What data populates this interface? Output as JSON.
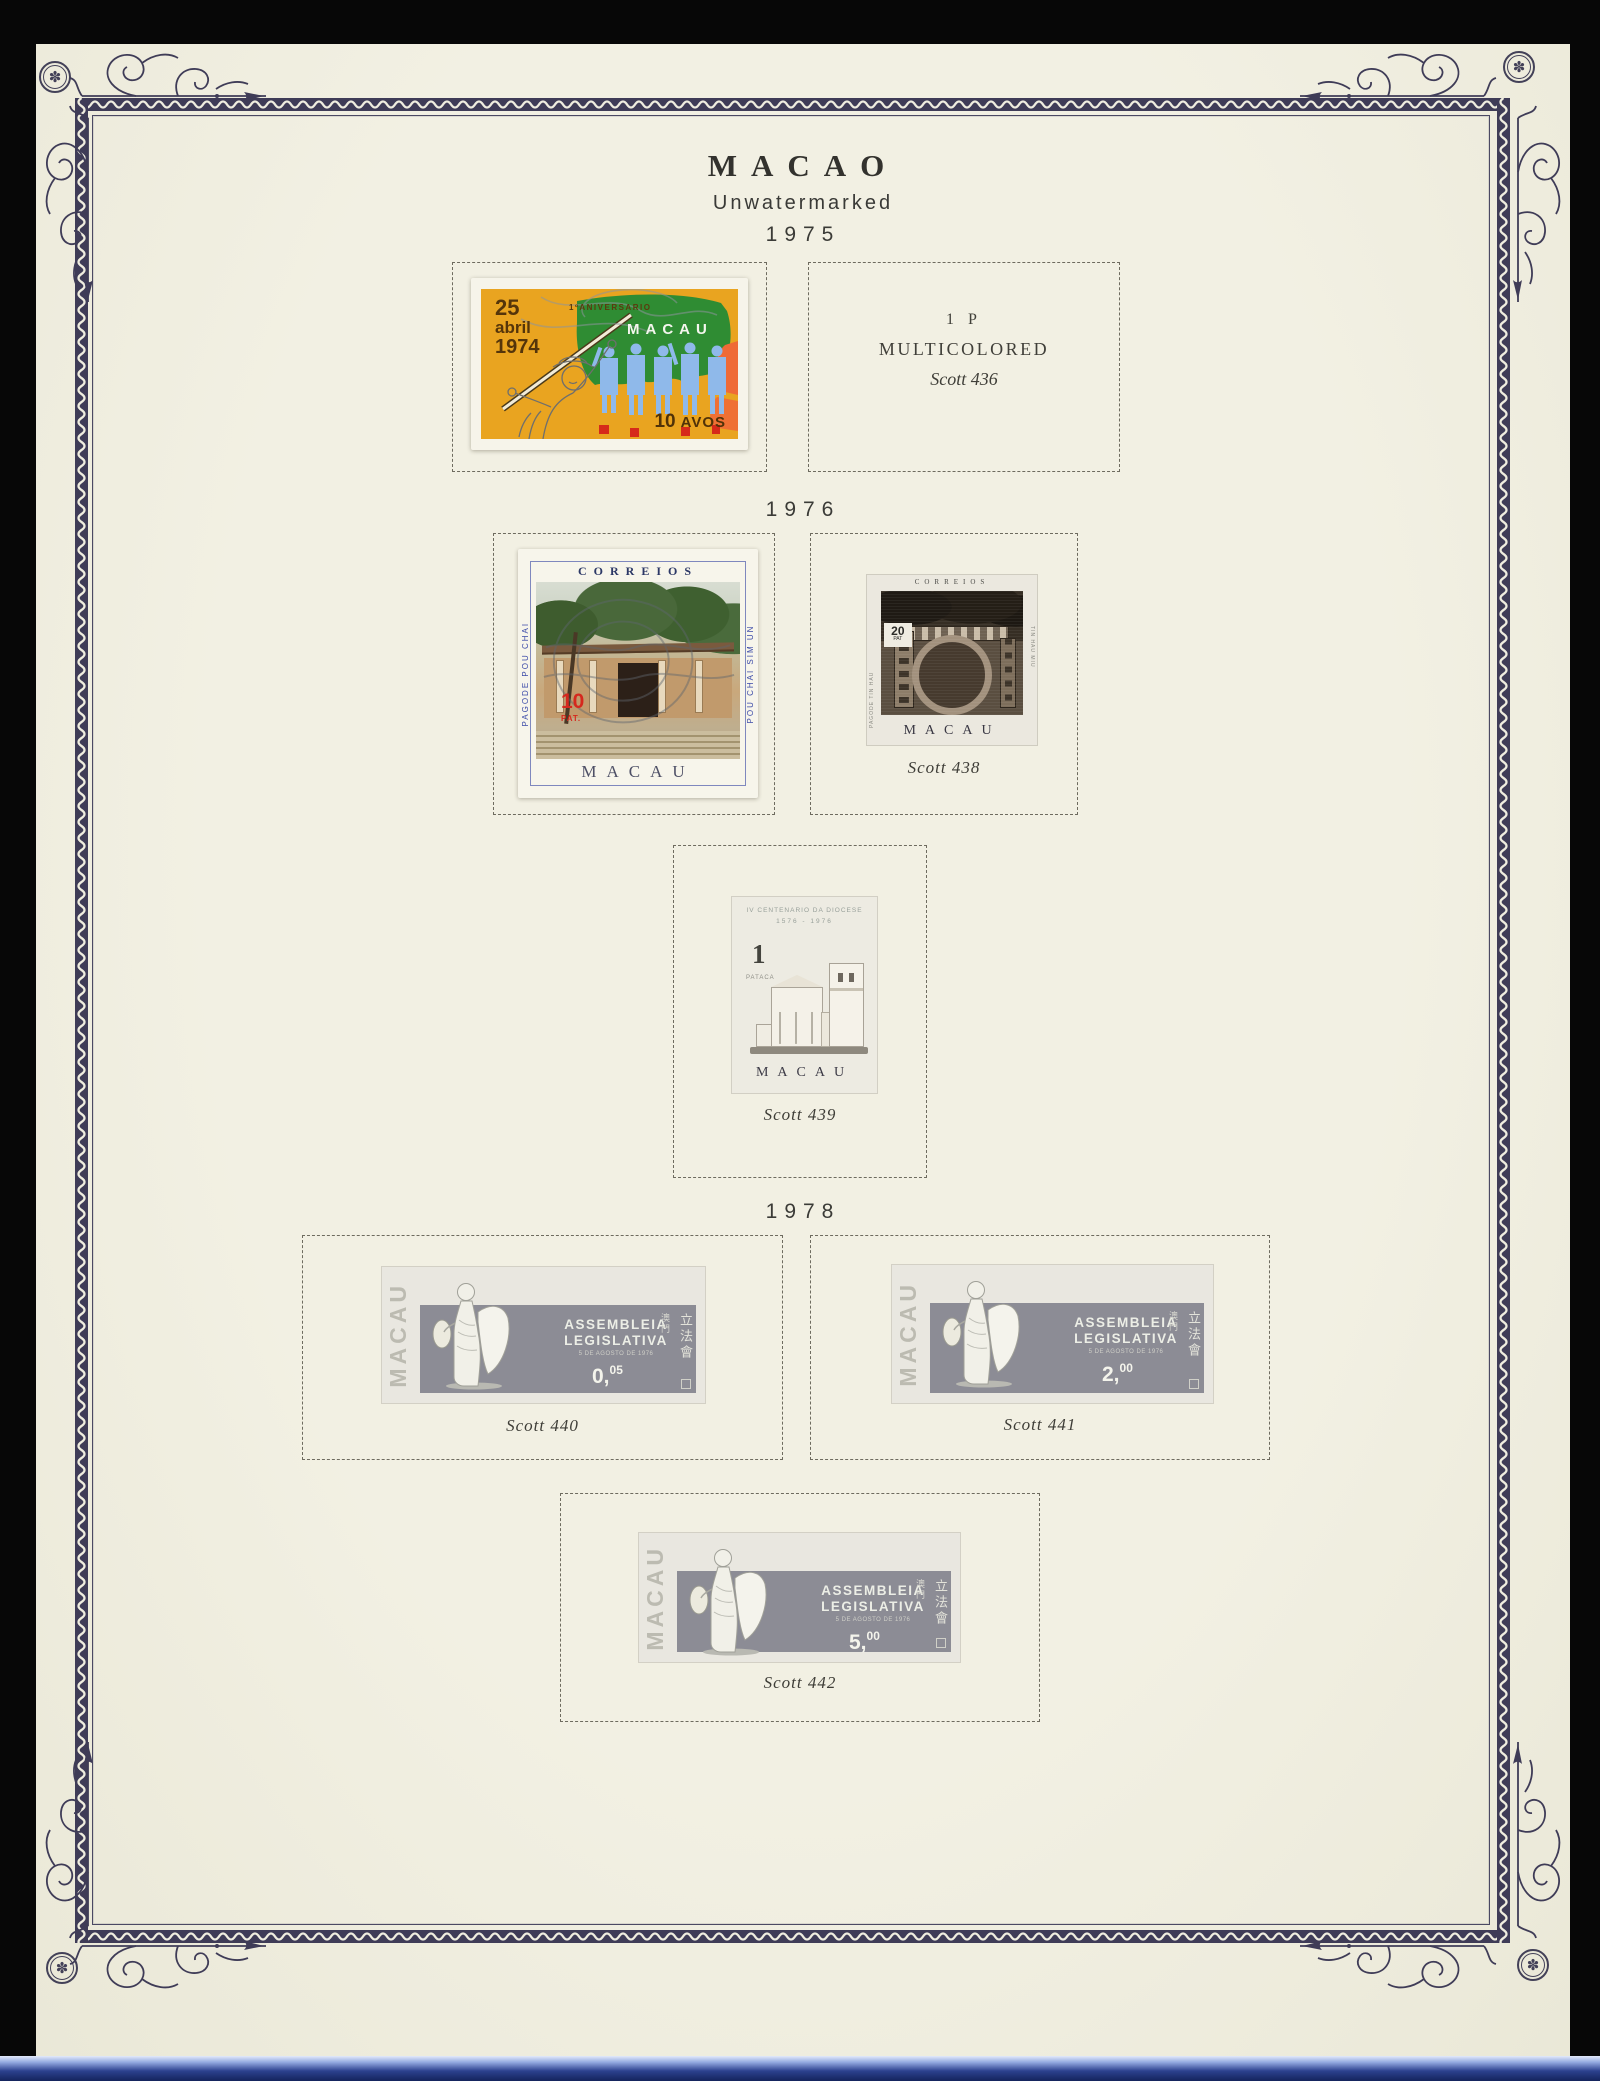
{
  "titles": {
    "country": "MACAO",
    "watermark": "Unwatermarked",
    "year_1975": "1975",
    "year_1976": "1976",
    "year_1978": "1978"
  },
  "icons": {
    "rosette_flower": "✽"
  },
  "slot_436": {
    "value": "1 P",
    "color": "MULTICOLORED",
    "caption": "Scott 436"
  },
  "stamp_anniversary": {
    "day": "25",
    "month": "abril",
    "year": "1974",
    "top_text": "1ºANIVERSARIO",
    "country": "MACAU",
    "value": "10",
    "unit": "AVOS"
  },
  "stamp_pou_chai": {
    "header": "CORREIOS",
    "left_text": "PAGODE POU CHAI",
    "right_text": "POU CHAI SIM UN",
    "value": "10",
    "unit": "PAT.",
    "country": "MACAU"
  },
  "stamp_tin_hau": {
    "header": "CORREIOS",
    "value": "20",
    "unit": "PAT",
    "left_text": "PAGODE TIN HAU",
    "right_text": "TIN HAU MIU",
    "country": "MACAU",
    "caption": "Scott 438"
  },
  "stamp_diocese": {
    "line1": "IV CENTENARIO DA DIOCESE",
    "line2": "1576 - 1976",
    "value": "1",
    "unit": "PATACA",
    "country": "MACAU",
    "caption": "Scott 439"
  },
  "assembleia": {
    "country": "MACAU",
    "title1": "ASSEMBLEIA",
    "title2": "LEGISLATIVA",
    "subtitle": "5 DE AGOSTO DE 1976",
    "cjk_small": "澳門",
    "cjk_large": "立法會",
    "s440": {
      "value_main": "0,",
      "value_dec": "05",
      "caption": "Scott 440"
    },
    "s441": {
      "value_main": "2,",
      "value_dec": "00",
      "caption": "Scott 441"
    },
    "s442": {
      "value_main": "5,",
      "value_dec": "00",
      "caption": "Scott 442"
    }
  },
  "colors": {
    "paper": "#f0eee1",
    "border_ink": "#3f3c57",
    "stamp1_bg": "#e9a420",
    "stamp1_flag": "#2f8c33",
    "stamp1_figures": "#8fb9ea",
    "stamp1_accent": "#ef6a36",
    "value_red": "#d5281e",
    "bottom_strip": "#14235c"
  }
}
